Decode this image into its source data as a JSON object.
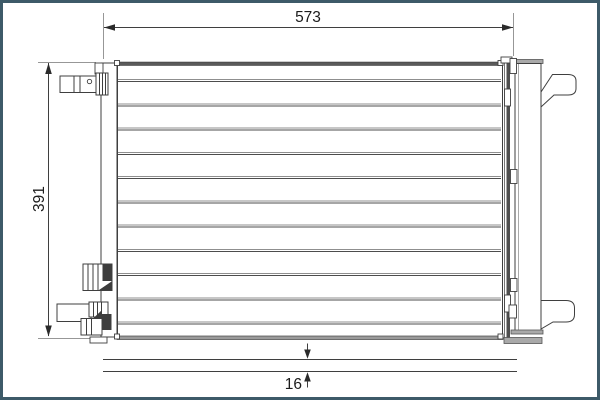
{
  "page": {
    "background": "#ffffff",
    "frame_color": "#3d5a68"
  },
  "diagram": {
    "type": "technical-dimension-drawing",
    "subject": "air-conditioning-condenser-front-view",
    "dimensions": {
      "width_label": "573",
      "height_label": "391",
      "depth_label": "16"
    },
    "core": {
      "tube_line_count": 11,
      "tube_first_y": 79.5,
      "tube_spacing": 24.25
    },
    "colors": {
      "outline": "#3f3f3f",
      "dark_fill": "#3d3d3d",
      "light_gray_bar": "#a9a9a9",
      "extension_line": "#979797"
    }
  }
}
